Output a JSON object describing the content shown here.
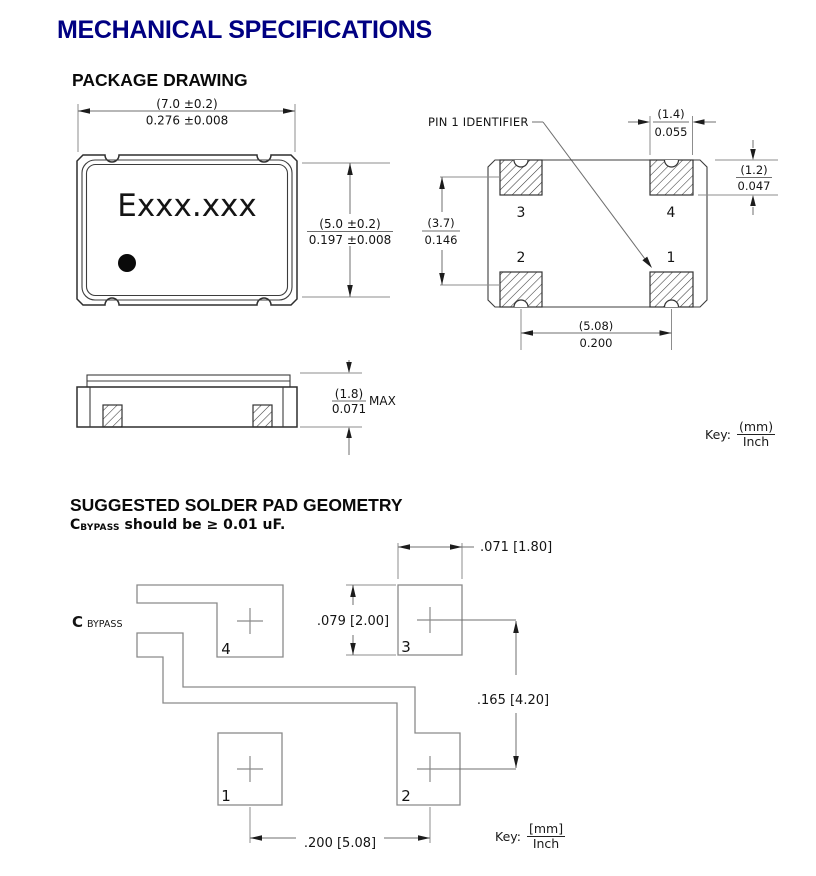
{
  "title": {
    "text": "MECHANICAL SPECIFICATIONS",
    "color": "#000082"
  },
  "package_drawing": {
    "heading": "PACKAGE DRAWING",
    "top_view": {
      "part_label": "Exxx.xxx",
      "width_mm": "(7.0 ±0.2)",
      "width_inch": "0.276 ±0.008",
      "height_mm": "(5.0 ±0.2)",
      "height_inch": "0.197 ±0.008"
    },
    "side_view": {
      "thickness_mm": "(1.8)",
      "thickness_inch": "0.071",
      "qualifier": "MAX"
    },
    "pin_view": {
      "callout": "PIN 1 IDENTIFIER",
      "pin_top_left": "3",
      "pin_top_right": "4",
      "pin_bottom_left": "2",
      "pin_bottom_right": "1",
      "pad_width_mm": "(1.4)",
      "pad_width_inch": "0.055",
      "pad_height_mm": "(1.2)",
      "pad_height_inch": "0.047",
      "row_pitch_mm": "(3.7)",
      "row_pitch_inch": "0.146",
      "col_pitch_mm": "(5.08)",
      "col_pitch_inch": "0.200"
    },
    "key": {
      "label": "Key:",
      "top": "(mm)",
      "bottom": "Inch"
    }
  },
  "solder_pad_geometry": {
    "heading": "SUGGESTED SOLDER PAD GEOMETRY",
    "note_prefix": "C",
    "note_sub": "BYPASS",
    "note_rest": " should be ≥ 0.01 uF.",
    "cap_prefix": "C",
    "cap_sub": "BYPASS",
    "pad_top_left": "4",
    "pad_top_right": "3",
    "pad_bottom_left": "1",
    "pad_bottom_right": "2",
    "pad_width": ".071 [1.80]",
    "pad_height": ".079 [2.00]",
    "row_pitch": ".165 [4.20]",
    "col_pitch": ".200 [5.08]",
    "key": {
      "label": "Key:",
      "top": "[mm]",
      "bottom": "Inch"
    }
  }
}
